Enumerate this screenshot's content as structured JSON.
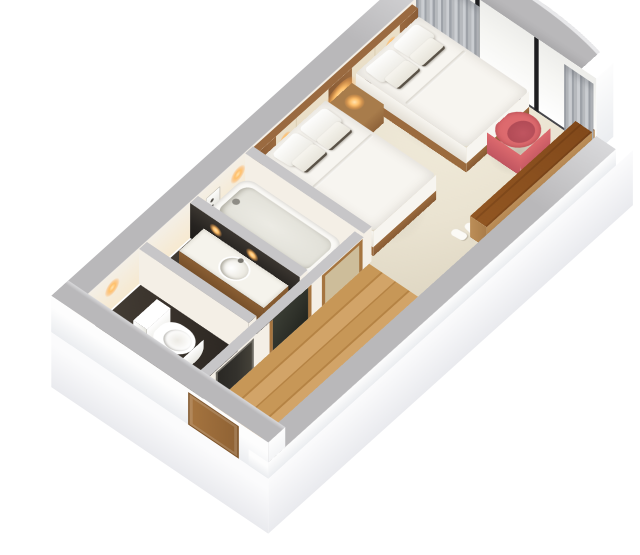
{
  "meta": {
    "description": "3D isometric cutaway floor plan render of a hotel guest room with twin double beds"
  },
  "palette": {
    "wall_top": "#b9b8ba",
    "wall_top_light": "#c7c6c8",
    "wall_outer": "#fdfdfd",
    "wall_outer_shade": "#ebedf0",
    "wall_inner": "#f4efe6",
    "wall_inner_warm": "#f6e9d0",
    "floor_bedroom": "#eae3d1",
    "floor_bedroom_light": "#f1ebda",
    "floor_wood": "#c79757",
    "floor_wood_dark": "#b58344",
    "floor_dark": "#3a332c",
    "floor_bath": "#efeadc",
    "linen": "#f7f5f0",
    "linen_shade": "#e3ded4",
    "bed_wood": "#9b6b3e",
    "headboard_wood": "#9a6a40",
    "headboard_panel": "#eadfc8",
    "headboard_dark": "#4a3a2b",
    "nightstand_wood": "#a87c4b",
    "lamp_glow": "#ffc06a",
    "chair_red": "#dd6a6e",
    "chair_red_dark": "#c05560",
    "console_wood": "#bc8e58",
    "console_wood_dark": "#a97c49",
    "curtain_a": "#b6b9bd",
    "curtain_b": "#9ea2a8",
    "mullion": "#1e1e20",
    "glass": "#f6f6f3",
    "tub_white": "#fbfaf7",
    "tub_inner": "#ecebe4",
    "porcelain": "#ffffff",
    "counter_top": "#f5f3ec",
    "vanity_wood": "#8a5e33",
    "mirror_dark": "#262320",
    "door_wood": "#a5743f",
    "door_glass": "#cdbd9a",
    "door_dark_glass": "#33312c",
    "wardrobe_dark": "#2e3029",
    "shadow_soft": "rgba(110,100,85,0.30)"
  },
  "scene": {
    "view": "axonometric cutaway, walls cut low, curved full-height window wall",
    "rooms": [
      {
        "name": "bedroom",
        "floor": "beige"
      },
      {
        "name": "entry-hallway",
        "floor": "wood planks"
      },
      {
        "name": "toilet-room",
        "floor": "dark tile",
        "fixtures": [
          "toilet"
        ]
      },
      {
        "name": "vanity-room",
        "floor": "dark tile",
        "fixtures": [
          "sink-counter",
          "mirror",
          "wall-lights"
        ]
      },
      {
        "name": "bathtub-room",
        "floor": "light tile",
        "fixtures": [
          "bathtub",
          "shower-panel"
        ]
      }
    ],
    "furniture": [
      {
        "name": "double-bed-inner",
        "details": "white linen, two pillows, two trimmed cushions, wood base"
      },
      {
        "name": "double-bed-near-window",
        "details": "white linen, two pillows, two trimmed cushions, wood base"
      },
      {
        "name": "headboard-feature-wall",
        "details": "wood and cream panels with dark headboard band"
      },
      {
        "name": "nightstand",
        "details": "wood, lit table lamp"
      },
      {
        "name": "red-armchair",
        "details": "coral tub chair by window"
      },
      {
        "name": "console-bench",
        "details": "long knotty-wood top along cut wall"
      },
      {
        "name": "slippers",
        "details": "white pair on bedroom floor"
      },
      {
        "name": "wardrobe-nook",
        "details": "dark recess with wood trim"
      },
      {
        "name": "entry-door",
        "details": "wood, on outer end wall"
      },
      {
        "name": "bathroom-door",
        "details": "wood frame with obscure glass"
      },
      {
        "name": "toilet-room-door",
        "details": "dark glass"
      },
      {
        "name": "curtains",
        "details": "gray folds at both ends of window wall"
      }
    ],
    "window_wall": {
      "panels": 3,
      "mullions": 2,
      "shape": "curved",
      "parapet": "gray curved band"
    }
  }
}
